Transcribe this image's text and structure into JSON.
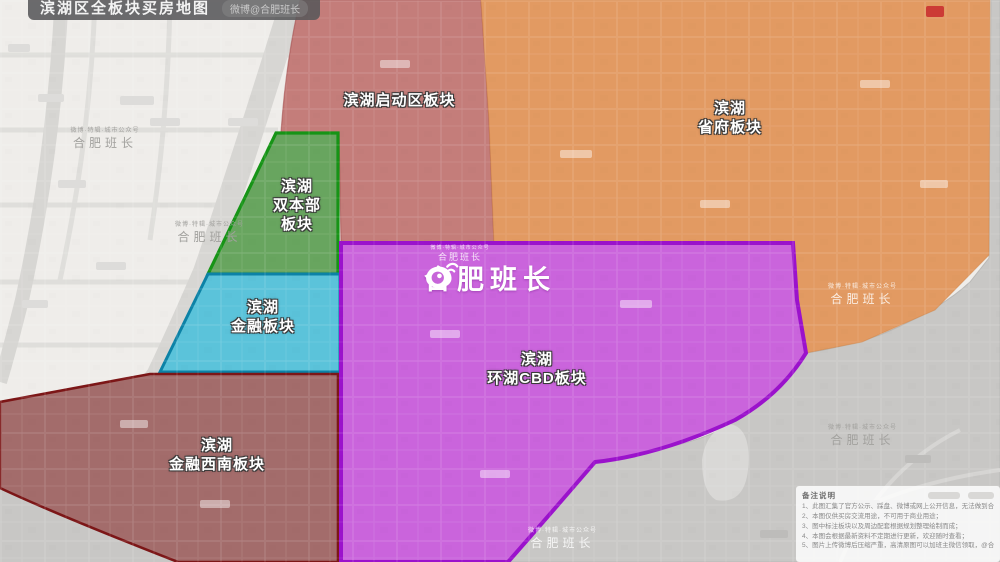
{
  "title": {
    "text": "滨湖区全板块买房地图",
    "handle": "微博@合肥班长"
  },
  "watermark": {
    "brand": "合肥班长",
    "subtitle": "微博·特辑·城市公众号"
  },
  "regions": [
    {
      "id": "qidongqu",
      "name": "滨湖启动区板块",
      "lines": [
        "滨湖启动区板块"
      ],
      "color": "#c47d7a",
      "border": "#a34d4d"
    },
    {
      "id": "shengfu",
      "name": "滨湖省府板块",
      "lines": [
        "滨湖",
        "省府板块"
      ],
      "color": "#e29a62",
      "border": "#cf8445"
    },
    {
      "id": "shuangbenbu",
      "name": "滨湖双本部板块",
      "lines": [
        "滨湖",
        "双本部",
        "板块"
      ],
      "color": "#68a55f",
      "border": "#169416"
    },
    {
      "id": "jinrong",
      "name": "滨湖金融板块",
      "lines": [
        "滨湖",
        "金融板块"
      ],
      "color": "#5bc3da",
      "border": "#0c82a6"
    },
    {
      "id": "huanhu-cbd",
      "name": "滨湖环湖CBD板块",
      "lines": [
        "滨湖",
        "环湖CBD板块"
      ],
      "color": "#ca64dc",
      "border": "#9b12cc"
    },
    {
      "id": "jinrong-xinan",
      "name": "滨湖金融西南板块",
      "lines": [
        "滨湖",
        "金融西南板块"
      ],
      "color": "#a36c6b",
      "border": "#7c1617"
    }
  ],
  "notes": {
    "heading": "备注说明",
    "items": [
      "1、此图汇集了官方公示、踩盘、微博或网上公开信息，无法做到合肥地区实时更新及交流相同步；",
      "2、本图仅供买房交流用途，不可用于商业用途；",
      "3、图中标注板块以及周边配套根据规划整理绘制而成；",
      "4、本图会根据最新资料不定期进行更新，欢迎随时查看；",
      "5、图片上传微博后压缩严重，高清原图可以加班主微信领取，@合肥班长"
    ]
  },
  "colors": {
    "base_map": "#efedea",
    "lake": "#c8c7c5",
    "highway": "#d7d6d3"
  }
}
